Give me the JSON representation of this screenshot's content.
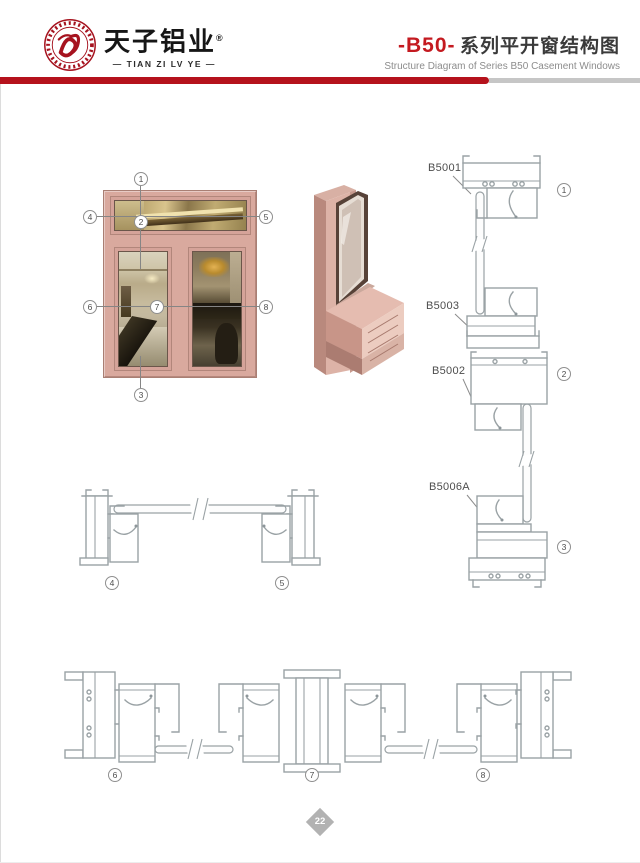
{
  "header": {
    "brand": {
      "name_cn": "天子铝业",
      "registered_mark": "®",
      "name_en": "— TIAN ZI LV YE —"
    },
    "series_code": "-B50-",
    "title_cn": "系列平开窗结构图",
    "title_en": "Structure Diagram of Series B50 Casement Windows"
  },
  "window_diagram": {
    "callouts": [
      "1",
      "2",
      "3",
      "4",
      "5",
      "6",
      "7",
      "8"
    ]
  },
  "sections": {
    "vertical": {
      "labels": [
        "B5001",
        "B5003",
        "B5002",
        "B5006A"
      ],
      "markers": [
        "1",
        "2",
        "3"
      ]
    },
    "horizontal_upper": {
      "markers": [
        "4",
        "5"
      ]
    },
    "horizontal_lower": {
      "markers": [
        "6",
        "7",
        "8"
      ]
    }
  },
  "footer": {
    "page_number": "22"
  },
  "colors": {
    "accent_red": "#b5121c",
    "frame_pink": "#d9a99e",
    "drawing_line": "#9aa2a5",
    "diamond_gray": "#b2b2b2"
  }
}
